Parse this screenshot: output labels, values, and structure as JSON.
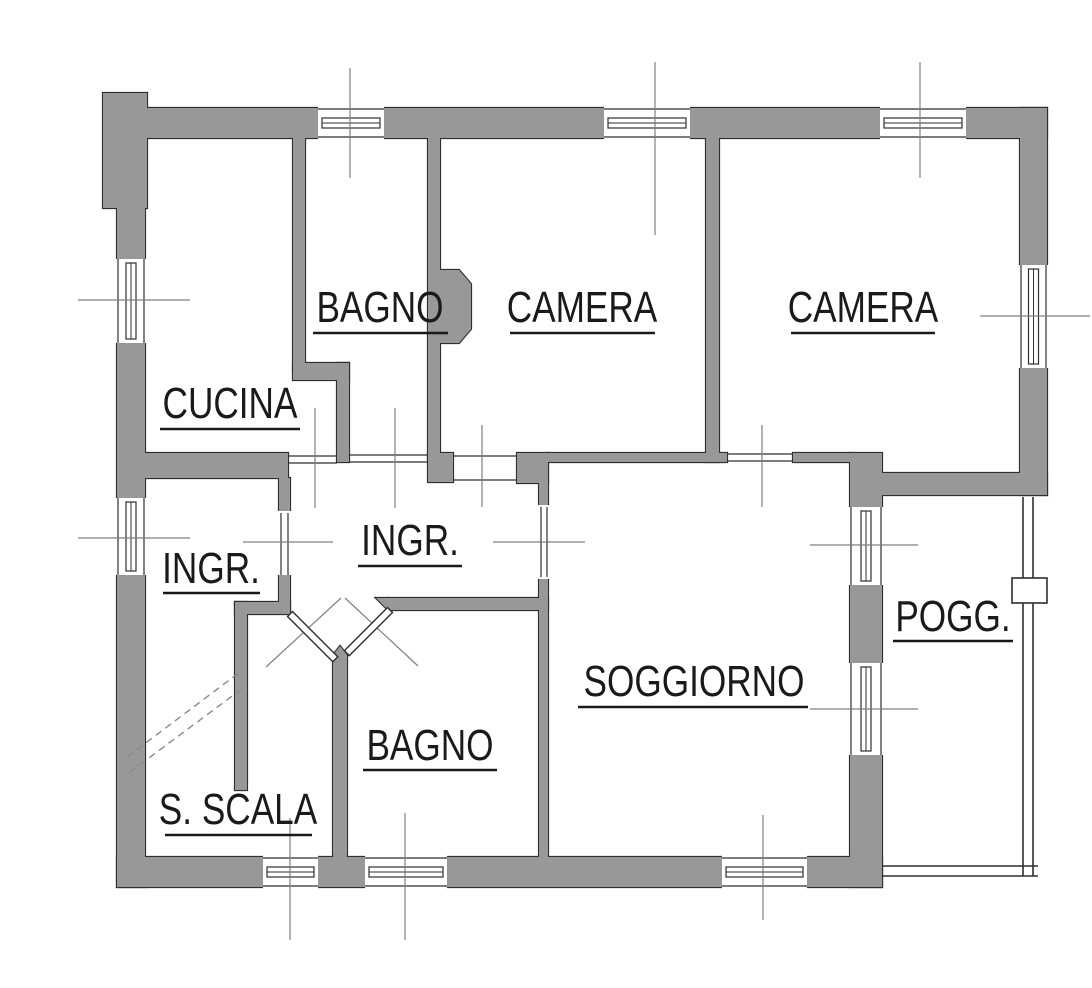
{
  "plan": {
    "width": 1092,
    "height": 988,
    "colors": {
      "background": "#ffffff",
      "wall_fill": "#989898",
      "wall_outline": "#2e2e2e",
      "thin_line": "#2e2e2e",
      "centerline": "#808080",
      "dashed_line": "#8a8a8a",
      "text": "#1a1a1a"
    },
    "rooms": [
      {
        "id": "bagno-top",
        "label": "BAGNO",
        "cx": 380,
        "baseline": 322,
        "underline": {
          "x1": 313,
          "x2": 448,
          "y": 333
        }
      },
      {
        "id": "camera-1",
        "label": "CAMERA",
        "cx": 582,
        "baseline": 322,
        "underline": {
          "x1": 510,
          "x2": 655,
          "y": 333
        }
      },
      {
        "id": "camera-2",
        "label": "CAMERA",
        "cx": 863,
        "baseline": 322,
        "underline": {
          "x1": 791,
          "x2": 935,
          "y": 333
        }
      },
      {
        "id": "cucina",
        "label": "CUCINA",
        "cx": 230,
        "baseline": 418,
        "underline": {
          "x1": 160,
          "x2": 300,
          "y": 429
        }
      },
      {
        "id": "ingr-vestibolo",
        "label": "INGR.",
        "cx": 211,
        "baseline": 583,
        "underline": {
          "x1": 163,
          "x2": 260,
          "y": 593
        }
      },
      {
        "id": "ingr-hall",
        "label": "INGR.",
        "cx": 410,
        "baseline": 555,
        "underline": {
          "x1": 358,
          "x2": 462,
          "y": 566
        }
      },
      {
        "id": "pogg",
        "label": "POGG.",
        "cx": 953,
        "baseline": 631,
        "underline": {
          "x1": 893,
          "x2": 1013,
          "y": 641
        }
      },
      {
        "id": "soggiorno",
        "label": "SOGGIORNO",
        "cx": 694,
        "baseline": 696,
        "underline": {
          "x1": 578,
          "x2": 808,
          "y": 707
        }
      },
      {
        "id": "bagno-bottom",
        "label": "BAGNO",
        "cx": 430,
        "baseline": 760,
        "underline": {
          "x1": 363,
          "x2": 497,
          "y": 770
        }
      },
      {
        "id": "s-scala",
        "label": "S. SCALA",
        "cx": 238,
        "baseline": 824,
        "underline": {
          "x1": 165,
          "x2": 312,
          "y": 835
        }
      }
    ],
    "walls": {
      "rects": [
        [
          103,
          93,
          44,
          115
        ],
        [
          117,
          108,
          930,
          30
        ],
        [
          117,
          138,
          28,
          749
        ],
        [
          1020,
          108,
          27,
          387
        ],
        [
          878,
          473,
          169,
          22
        ],
        [
          850,
          453,
          32,
          434
        ],
        [
          117,
          857,
          765,
          30
        ],
        [
          293,
          138,
          12,
          232
        ],
        [
          293,
          363,
          56,
          17
        ],
        [
          337,
          363,
          12,
          99
        ],
        [
          428,
          138,
          12,
          324
        ],
        [
          428,
          453,
          25,
          29
        ],
        [
          145,
          453,
          143,
          25
        ],
        [
          279,
          478,
          11,
          135
        ],
        [
          235,
          602,
          55,
          12
        ],
        [
          235,
          602,
          12,
          188
        ],
        [
          706,
          138,
          13,
          324
        ],
        [
          548,
          453,
          179,
          9
        ],
        [
          793,
          453,
          57,
          9
        ],
        [
          517,
          453,
          31,
          30
        ],
        [
          539,
          463,
          9,
          394
        ],
        [
          388,
          598,
          160,
          12
        ],
        [
          333,
          655,
          14,
          202
        ]
      ],
      "polys": [
        [
          [
            440,
            270
          ],
          [
            459,
            270
          ],
          [
            471,
            284
          ],
          [
            471,
            329
          ],
          [
            459,
            343
          ],
          [
            440,
            343
          ]
        ],
        [
          [
            376,
            598
          ],
          [
            388,
            598
          ],
          [
            388,
            610
          ]
        ],
        [
          [
            333,
            655
          ],
          [
            340,
            646
          ],
          [
            347,
            655
          ]
        ]
      ]
    },
    "windows": [
      {
        "dir": "h",
        "x": 318,
        "y": 108,
        "w": 66,
        "h": 30
      },
      {
        "dir": "h",
        "x": 604,
        "y": 108,
        "w": 86,
        "h": 30
      },
      {
        "dir": "h",
        "x": 880,
        "y": 108,
        "w": 86,
        "h": 30
      },
      {
        "dir": "v",
        "x": 117,
        "y": 259,
        "w": 28,
        "h": 84
      },
      {
        "dir": "v",
        "x": 117,
        "y": 498,
        "w": 28,
        "h": 77
      },
      {
        "dir": "v",
        "x": 1020,
        "y": 265,
        "w": 27,
        "h": 103
      },
      {
        "dir": "v",
        "x": 850,
        "y": 507,
        "w": 32,
        "h": 78
      },
      {
        "dir": "v",
        "x": 850,
        "y": 663,
        "w": 32,
        "h": 92
      },
      {
        "dir": "h",
        "x": 263,
        "y": 857,
        "w": 55,
        "h": 30
      },
      {
        "dir": "h",
        "x": 365,
        "y": 857,
        "w": 82,
        "h": 30
      },
      {
        "dir": "h",
        "x": 722,
        "y": 857,
        "w": 85,
        "h": 30
      }
    ],
    "openings": [
      {
        "lines": [
          [
            288,
            456,
            337,
            456
          ],
          [
            288,
            463,
            337,
            463
          ]
        ]
      },
      {
        "lines": [
          [
            349,
            455,
            428,
            455
          ],
          [
            349,
            462,
            428,
            462
          ]
        ]
      },
      {
        "lines": [
          [
            453,
            456,
            517,
            456
          ],
          [
            453,
            480,
            517,
            480
          ]
        ]
      },
      {
        "lines": [
          [
            727,
            454,
            793,
            454
          ],
          [
            727,
            461,
            793,
            461
          ]
        ]
      },
      {
        "punch": [
          276,
          511,
          17,
          64
        ],
        "lines": [
          [
            281,
            513,
            281,
            575
          ],
          [
            288,
            513,
            288,
            575
          ]
        ]
      },
      {
        "punch": [
          536,
          505,
          15,
          74
        ],
        "lines": [
          [
            541,
            507,
            541,
            577
          ],
          [
            547,
            507,
            547,
            577
          ]
        ]
      }
    ],
    "centerlines": [
      [
        350,
        68,
        350,
        178
      ],
      [
        655,
        62,
        655,
        235
      ],
      [
        920,
        62,
        920,
        178
      ],
      [
        78,
        300,
        190,
        300
      ],
      [
        78,
        538,
        190,
        538
      ],
      [
        980,
        316,
        1090,
        316
      ],
      [
        315,
        408,
        315,
        508
      ],
      [
        395,
        408,
        395,
        508
      ],
      [
        482,
        425,
        482,
        507
      ],
      [
        762,
        425,
        762,
        507
      ],
      [
        243,
        542,
        333,
        542
      ],
      [
        493,
        542,
        585,
        542
      ],
      [
        810,
        545,
        918,
        545
      ],
      [
        810,
        709,
        918,
        709
      ],
      [
        290,
        818,
        290,
        940
      ],
      [
        405,
        813,
        405,
        940
      ],
      [
        763,
        815,
        763,
        920
      ]
    ],
    "stair_dashes": [
      [
        127,
        757,
        240,
        672
      ],
      [
        130,
        772,
        243,
        688
      ]
    ],
    "door_leaves": [
      {
        "hx": 290,
        "hy": 614,
        "len": 64,
        "angle": 45
      },
      {
        "hx": 390,
        "hy": 610,
        "len": 61,
        "angle": 135
      }
    ],
    "swing_lines": [
      [
        266,
        667,
        341,
        598
      ],
      [
        345,
        598,
        418,
        666
      ]
    ],
    "railing": {
      "v_lines": [
        [
          1023,
          497,
          1023,
          876
        ],
        [
          1033,
          497,
          1033,
          876
        ]
      ],
      "h_lines": [
        [
          882,
          866,
          1038,
          866
        ],
        [
          882,
          876,
          1038,
          876
        ]
      ],
      "post": [
        1012,
        578,
        35,
        25
      ]
    }
  }
}
